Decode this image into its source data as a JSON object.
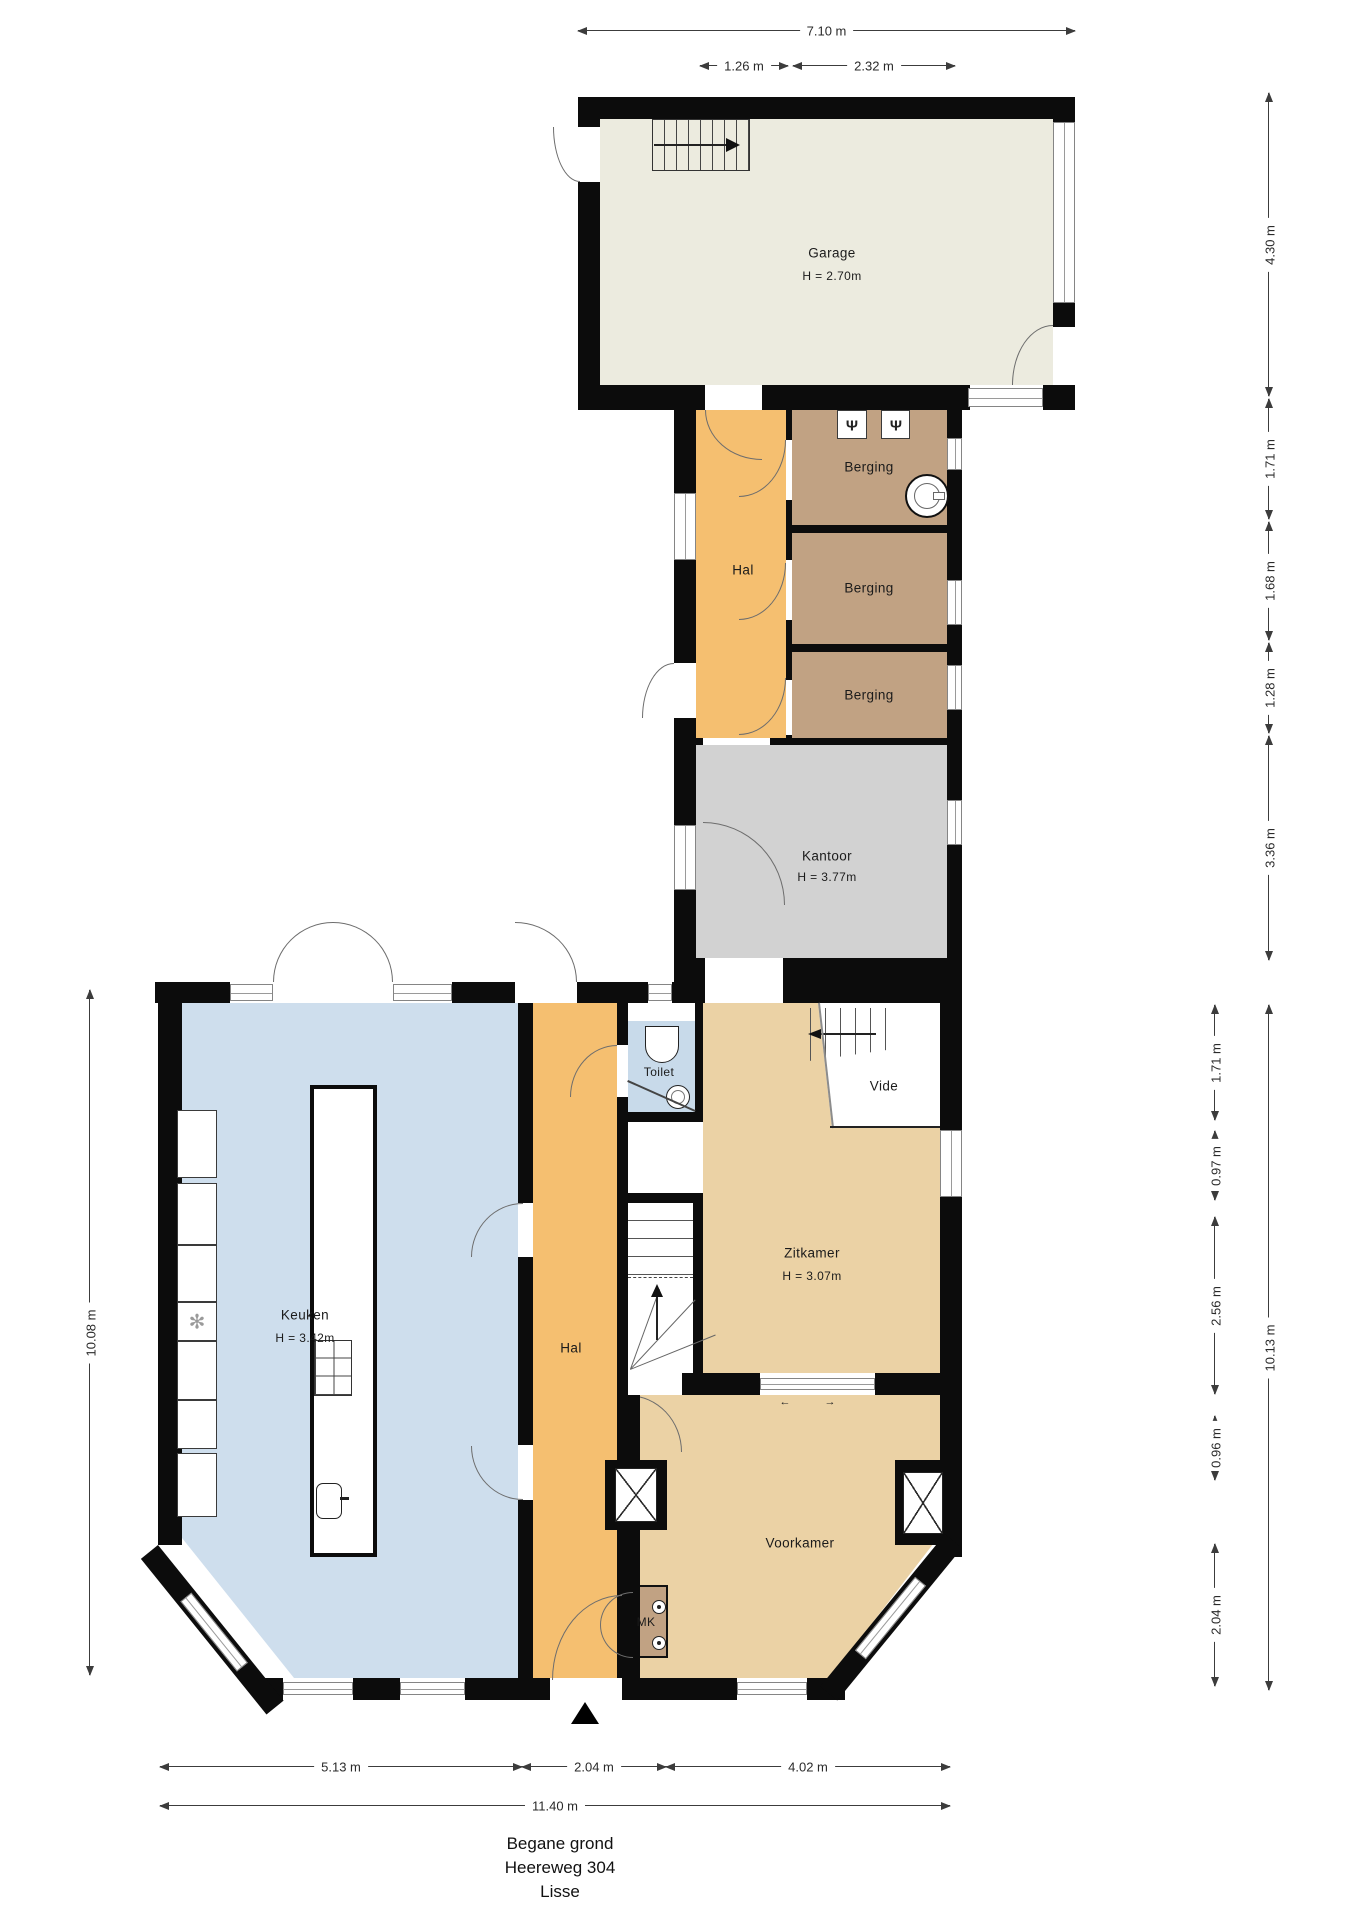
{
  "plan": {
    "floor_title": "Begane grond",
    "address": "Heereweg 304",
    "city": "Lisse"
  },
  "rooms": {
    "garage": {
      "name": "Garage",
      "height": "H = 2.70m"
    },
    "hal_mid": {
      "name": "Hal"
    },
    "berging1": {
      "name": "Berging"
    },
    "berging2": {
      "name": "Berging"
    },
    "berging3": {
      "name": "Berging"
    },
    "kantoor": {
      "name": "Kantoor",
      "height": "H = 3.77m"
    },
    "keuken": {
      "name": "Keuken",
      "height": "H = 3.42m"
    },
    "hal_low": {
      "name": "Hal"
    },
    "toilet": {
      "name": "Toilet"
    },
    "vide": {
      "name": "Vide"
    },
    "zitkamer": {
      "name": "Zitkamer",
      "height": "H = 3.07m"
    },
    "voorkamer": {
      "name": "Voorkamer"
    },
    "mk": {
      "name": "MK"
    }
  },
  "dims": {
    "top": [
      "7.10 m",
      "1.26 m",
      "2.32 m"
    ],
    "right_upper": [
      "4.30 m",
      "1.71 m",
      "1.68 m",
      "1.28 m",
      "3.36 m"
    ],
    "right_inner": [
      "1.71 m",
      "0.97 m",
      "2.56 m",
      "0.96 m",
      "2.04 m"
    ],
    "right_total": "10.13 m",
    "left_total": "10.08 m",
    "bottom": [
      "5.13 m",
      "2.04 m",
      "4.02 m"
    ],
    "bottom_total": "11.40 m"
  },
  "icons": {
    "coat_hook": "Ψ",
    "extractor_fan": "✻",
    "slide_left": "←",
    "slide_right": "→"
  },
  "colors": {
    "wall": "#0c0c0c",
    "garage_floor": "#ecebdf",
    "hal_floor": "#f5bf70",
    "berging_floor": "#c1a283",
    "kantoor_floor": "#d2d2d2",
    "keuken_floor": "#cedeed",
    "toilet_floor": "#c8daea",
    "living_floor": "#ebd2a5"
  }
}
